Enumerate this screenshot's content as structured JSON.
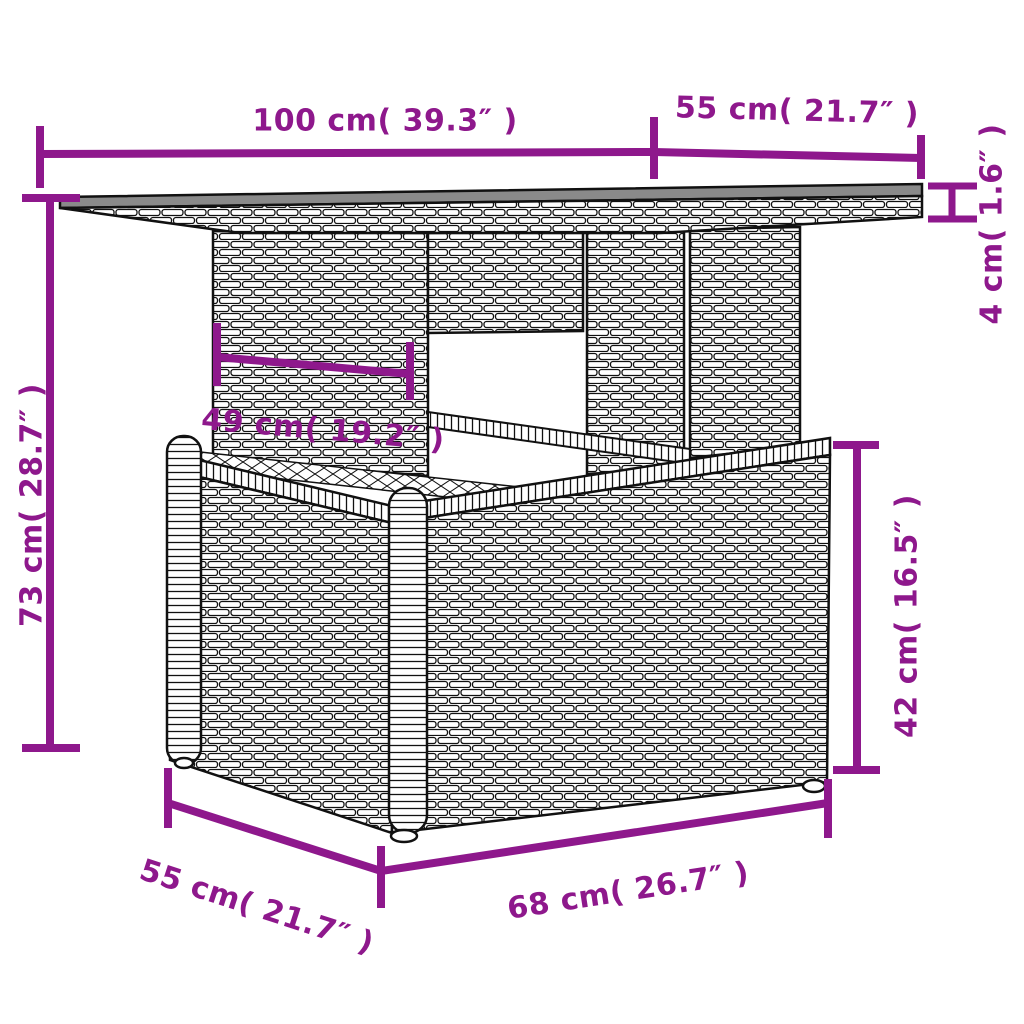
{
  "page": {
    "background_color": "#ffffff"
  },
  "diagram": {
    "kind": "product-dimension-diagram",
    "subject": "poly-rattan garden table with storage base",
    "accent_color": "#8E188C",
    "outline_color": "#111111",
    "tabletop_color": "#8a8a8a",
    "labels": {
      "top_width": "100 cm( 39.3″ )",
      "top_depth": "55 cm( 21.7″ )",
      "top_thickness": "4 cm( 1.6″ )",
      "overall_height": "73 cm( 28.7″ )",
      "inner_clearance": "49 cm( 19.2″ )",
      "base_height": "42 cm( 16.5″ )",
      "base_depth": "55 cm( 21.7″ )",
      "base_width": "68 cm( 26.7″ )"
    }
  }
}
